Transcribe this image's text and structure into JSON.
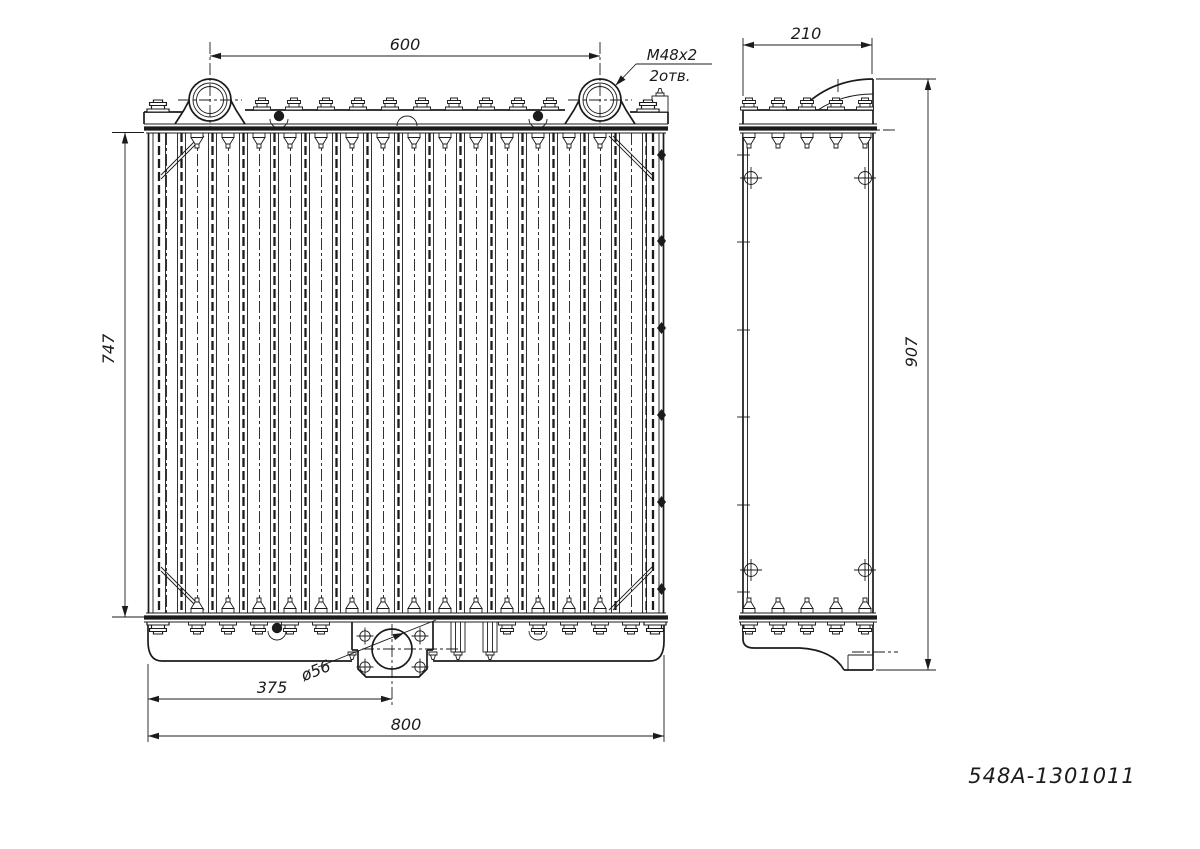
{
  "drawing": {
    "part_number": "548A-1301011",
    "colors": {
      "ink": "#1b1b1b",
      "paper": "#ffffff"
    },
    "front_view": {
      "neck_spacing": "600",
      "neck_thread": "M48x2",
      "neck_holes_note": "2отв.",
      "core_height": "747",
      "outlet_offset": "375",
      "outlet_diameter": "ø56",
      "overall_width": "800"
    },
    "side_view": {
      "depth": "210",
      "overall_height": "907"
    }
  }
}
